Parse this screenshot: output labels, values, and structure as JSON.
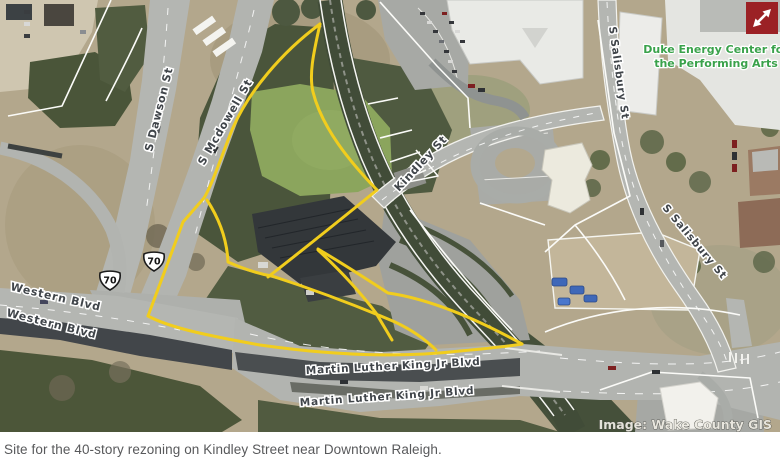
{
  "map": {
    "attribution": "Image: Wake County GIS",
    "expand_button": {
      "name": "expand",
      "color": "#9b2125"
    },
    "poi_label": {
      "line1": "Duke Energy Center for",
      "line2": "the Performing Arts",
      "color": "#3aa24b"
    },
    "street_labels": [
      {
        "text": "S Dawson St"
      },
      {
        "text": "S Mcdowell St"
      },
      {
        "text": "Kindley St"
      },
      {
        "text": "S Salisbury St"
      },
      {
        "text": "S Salisbury St"
      },
      {
        "text": "Western Blvd"
      },
      {
        "text": "Western Blvd"
      },
      {
        "text": "Martin Luther King Jr Blvd"
      },
      {
        "text": "Martin Luther King Jr Blvd"
      }
    ],
    "route_shields": [
      {
        "route": "70"
      },
      {
        "route": "70"
      }
    ],
    "parcel_outline_color": "#f1cd1d"
  },
  "caption": {
    "text": "Site for the 40-story rezoning on Kindley Street near Downtown Raleigh."
  }
}
